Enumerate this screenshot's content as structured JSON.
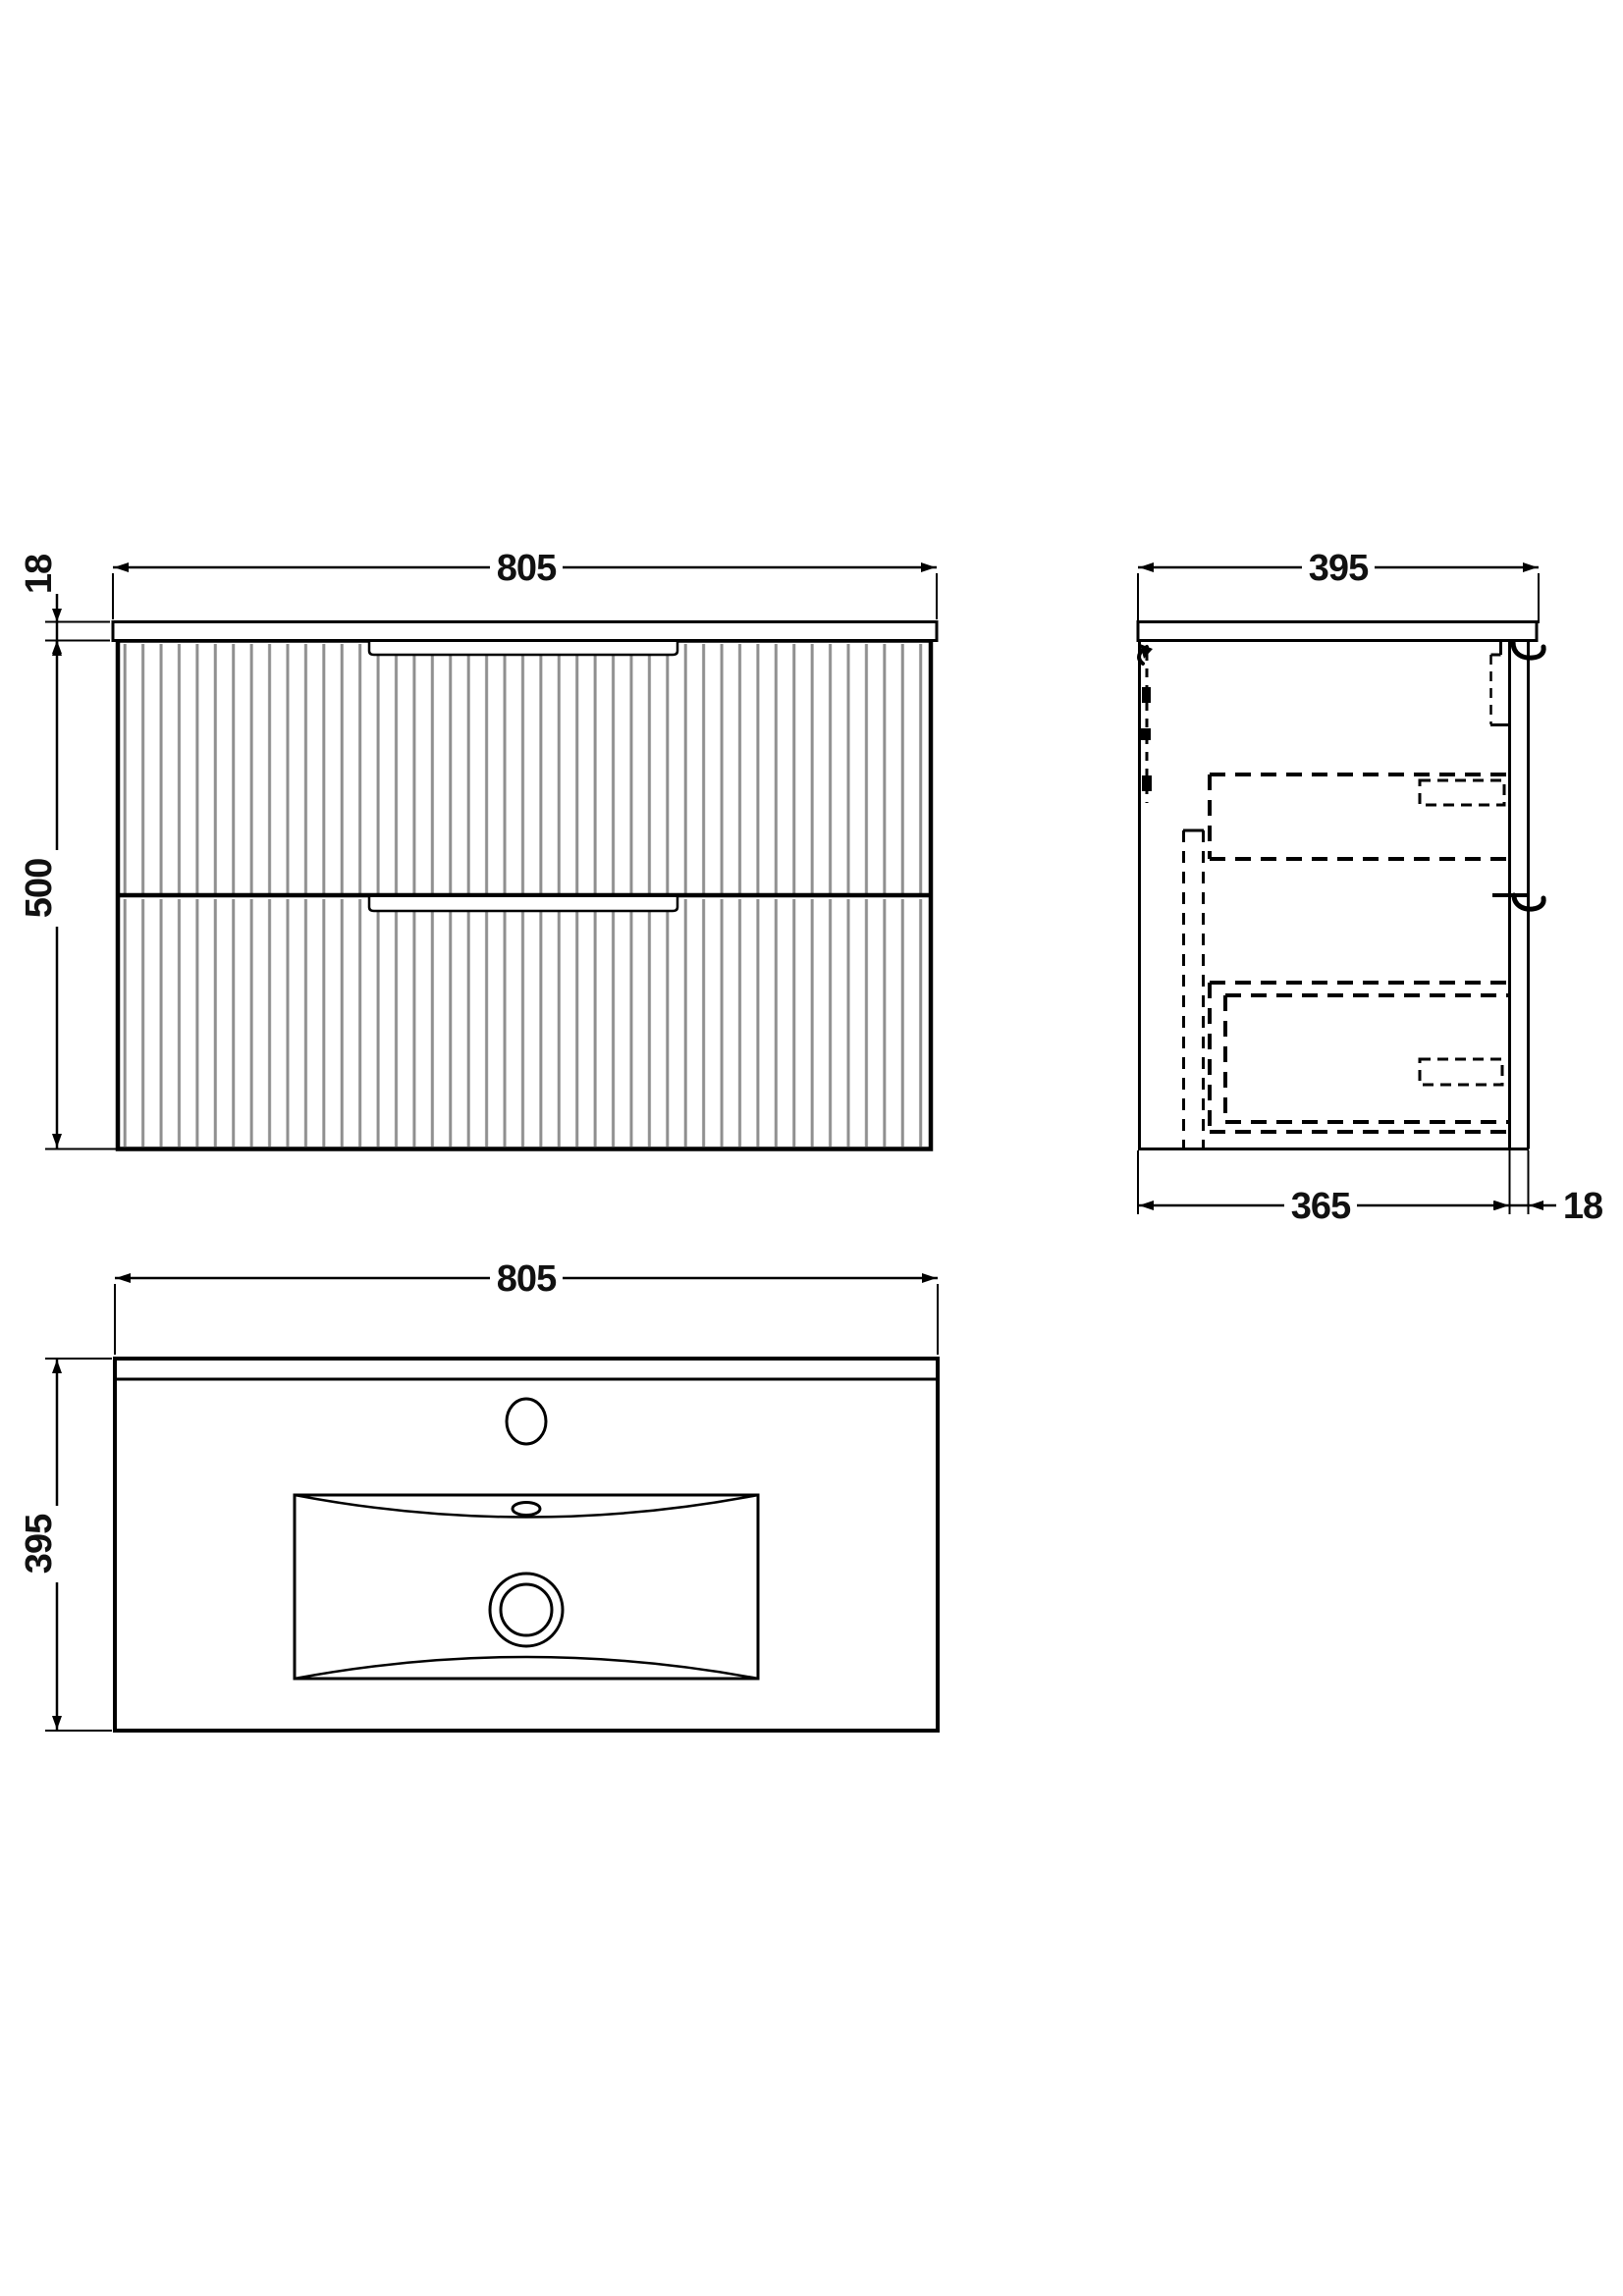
{
  "title": "Wall-hung vanity unit with basin — dimension drawing",
  "views": {
    "front": {
      "width": "805",
      "countertop_thickness": "18",
      "height": "500"
    },
    "side": {
      "depth": "395",
      "body_depth": "365",
      "back_panel_thickness": "18"
    },
    "plan": {
      "width": "805",
      "depth": "395"
    }
  },
  "colors": {
    "line": "#000000",
    "flute": "#8f8f8f",
    "text": "#111111",
    "background": "#ffffff"
  }
}
